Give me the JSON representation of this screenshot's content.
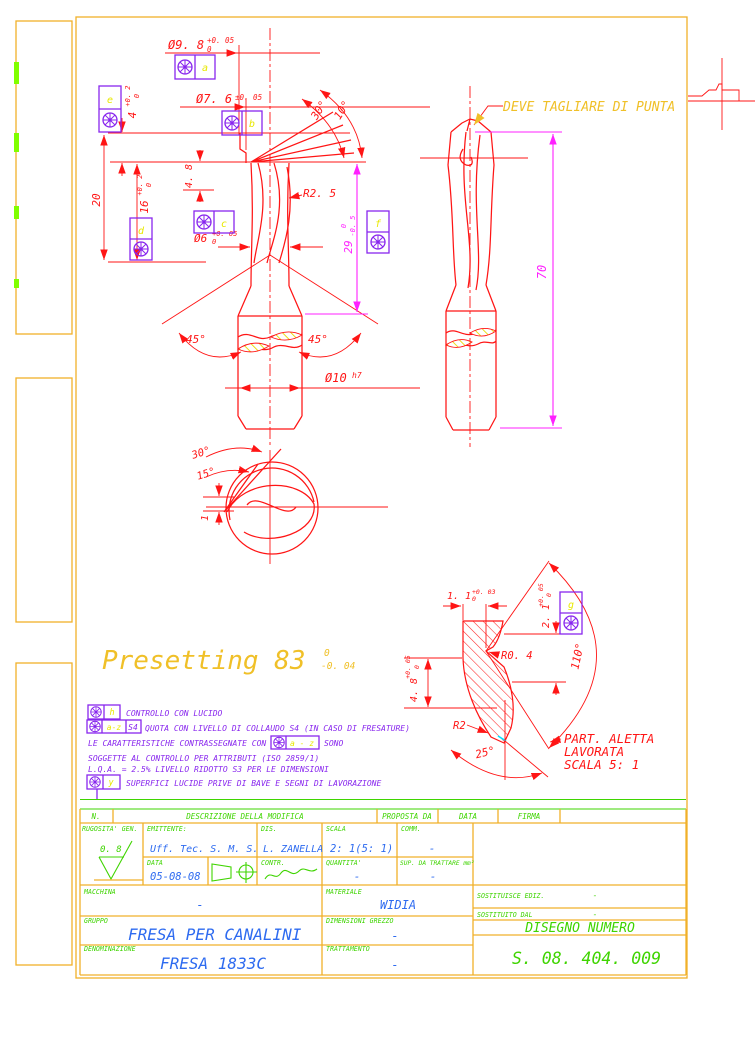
{
  "ann": {
    "deve": "DEVE TAGLIARE DI PUNTA",
    "preset": "Presetting 83",
    "preset_t": "0",
    "preset_b": "-0. 04"
  },
  "dims": {
    "d98": "Ø9. 8",
    "d98t": "+0. 05",
    "d98b": "0",
    "d76": "Ø7. 6",
    "d76t": "±0. 05",
    "d4": "4",
    "d4t": "+0. 2",
    "d4b": "0",
    "d20": "20",
    "d16": "16",
    "d16t": "+0. 2",
    "d16b": "0",
    "d48": "4. 8",
    "r25": "R2. 5",
    "d6": "Ø6",
    "d6t": "+0. 05",
    "d6b": "0",
    "d29": "29",
    "d29t": "0",
    "d29b": "-0. 5",
    "a45l": "45°",
    "a45r": "45°",
    "d10": "Ø10",
    "d10f": "h7",
    "a30": "30°",
    "a10": "10°",
    "s30": "30°",
    "s15": "15°",
    "s1": "1",
    "d70": "70"
  },
  "detail": {
    "d11": "1. 1",
    "d11t": "+0. 03",
    "d11b": "0",
    "d21": "2. 1",
    "d21t": "+0. 05",
    "d21b": "0",
    "r04": "R0. 4",
    "a110": "110°",
    "d48": "4. 8",
    "d48t": "+0. 05",
    "d48b": "0",
    "r2": "R2",
    "a25": "25°",
    "cap1": "PART.  ALETTA",
    "cap2": "LAVORATA",
    "cap3": "SCALA 5: 1"
  },
  "frames": {
    "a": "a",
    "b": "b",
    "c": "c",
    "d": "d",
    "e": "e",
    "f": "f",
    "g": "g",
    "h": "h",
    "y": "y",
    "az": "a-z",
    "s4": "S4",
    "az2": "a - z"
  },
  "notes": {
    "n1": "CONTROLLO CON LUCIDO",
    "n2": "QUOTA CON LIVELLO DI COLLAUDO S4 (IN CASO DI FRESATURE)",
    "n3a": "LE CARATTERISTICHE CONTRASSEGNATE CON",
    "n3b": "SONO",
    "n4": "SOGGETTE AL CONTROLLO PER ATTRIBUTI (ISO 2859/1)",
    "n5": "L.Q.A. = 2.5% LIVELLO RIDOTTO S3 PER LE DIMENSIONI",
    "n6": "SUPERFICI LUCIDE PRIVE DI BAVE E SEGNI DI LAVORAZIONE"
  },
  "tb": {
    "n": "N.",
    "descr": "DESCRIZIONE DELLA MODIFICA",
    "proposta": "PROPOSTA DA",
    "data1": "DATA",
    "firma": "FIRMA",
    "rugosita": "RUGOSITA' GEN.",
    "rugosita_val": "0. 8",
    "emittente": "EMITTENTE:",
    "emittente_val": "Uff.  Tec.  S. M. S.",
    "dis": "DIS.",
    "dis_val": "L. ZANELLA",
    "scala": "SCALA",
    "scala_val": "2: 1(5: 1)",
    "comm": "COMM.",
    "comm_val": "-",
    "data2": "DATA",
    "data2_val": "05-08-08",
    "contr": "CONTR.",
    "quantita": "QUANTITA'",
    "quantita_val": "-",
    "sup": "SUP. DA TRATTARE mm²",
    "sup_val": "-",
    "macchina": "MACCHINA",
    "macchina_val": "-",
    "materiale": "MATERIALE",
    "materiale_val": "WIDIA",
    "sost_ediz": "SOSTITUISCE EDIZ.",
    "sost_ediz_val": "-",
    "sost_dal": "SOSTITUITO DAL",
    "sost_dal_val": "-",
    "gruppo": "GRUPPO",
    "gruppo_val": "FRESA PER CANALINI",
    "dim_grezzo": "DIMENSIONI GREZZO",
    "dim_grezzo_val": "-",
    "disegno": "DISEGNO NUMERO",
    "disegno_val": "S. 08. 404. 009",
    "denominazione": "DENOMINAZIONE",
    "denominazione_val": "FRESA 1833C",
    "trattamento": "TRATTAMENTO",
    "trattamento_val": "-"
  },
  "colors": {
    "line_red": "#ff1515",
    "magenta": "#ff20ff",
    "purple": "#8826ee",
    "amber": "#f0c028",
    "border": "#f0b02a",
    "green": "#3fd400",
    "blue": "#2e6bf0",
    "yellow_letter": "#e8e800",
    "cyan": "#00e0ff"
  }
}
